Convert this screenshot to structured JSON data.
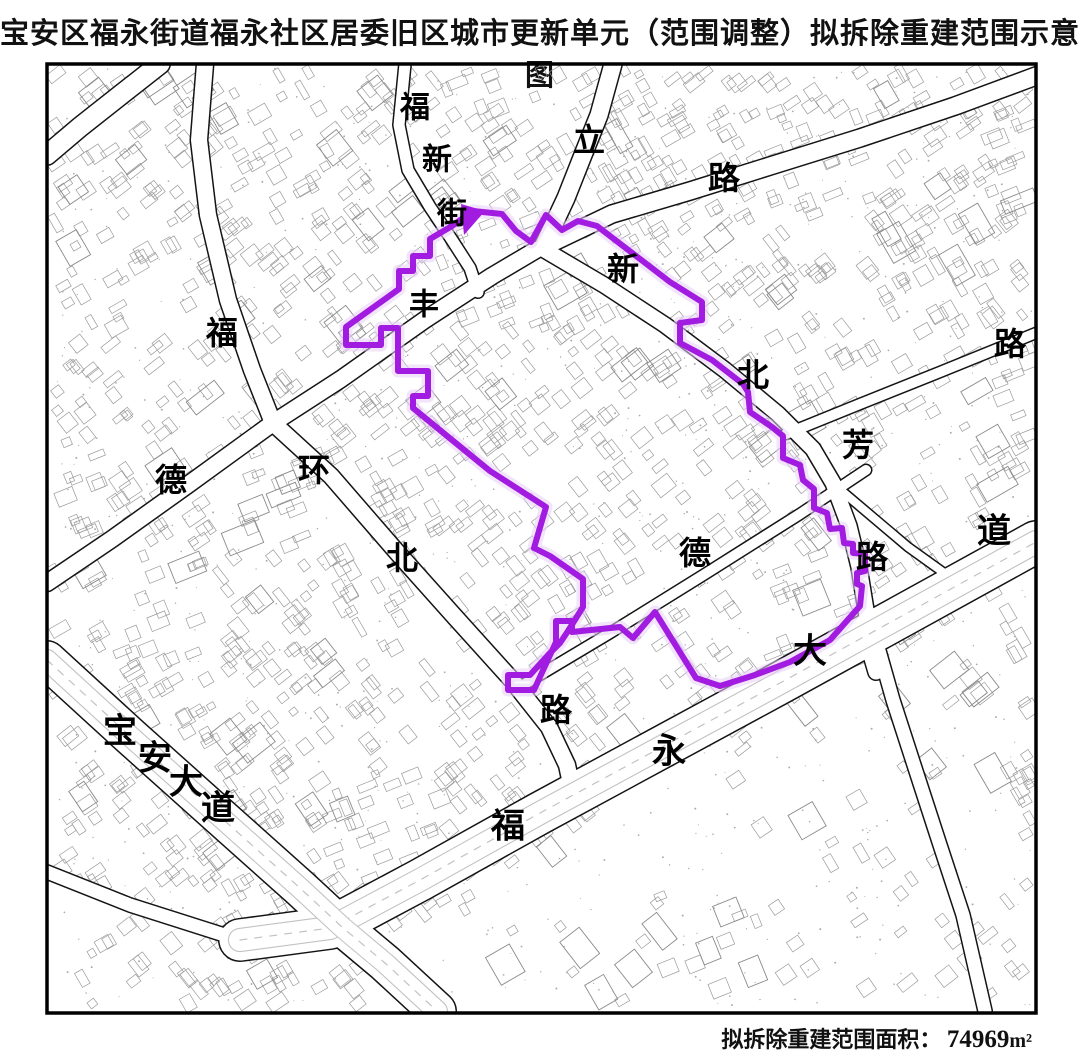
{
  "title": "宝安区福永街道福永社区居委旧区城市更新单元（范围调整）拟拆除重建范围示意图",
  "footer": {
    "label": "拟拆除重建范围面积：",
    "value": "74969",
    "unit": "m²"
  },
  "map": {
    "frame": {
      "x": 47,
      "y": 64,
      "w": 989,
      "h": 949
    },
    "colors": {
      "boundary": "#a21be0",
      "boundary_halo": "#e7cdf6",
      "road_casing": "#141414",
      "road_fill": "#ffffff",
      "avenue_inner": "#c2c2c2",
      "parcel": "#9b9b9b",
      "dot": "#ababab",
      "frame": "#000000",
      "label": "#000000"
    },
    "road_labels": [
      {
        "ch": "福",
        "x": 415,
        "y": 108,
        "s": 30
      },
      {
        "ch": "新",
        "x": 437,
        "y": 160,
        "s": 30
      },
      {
        "ch": "街",
        "x": 452,
        "y": 214,
        "s": 30
      },
      {
        "ch": "立",
        "x": 589,
        "y": 140,
        "s": 32
      },
      {
        "ch": "路",
        "x": 724,
        "y": 178,
        "s": 32
      },
      {
        "ch": "新",
        "x": 623,
        "y": 269,
        "s": 32
      },
      {
        "ch": "北",
        "x": 753,
        "y": 375,
        "s": 32
      },
      {
        "ch": "芳",
        "x": 858,
        "y": 445,
        "s": 32
      },
      {
        "ch": "路",
        "x": 1010,
        "y": 344,
        "s": 32
      },
      {
        "ch": "丰",
        "x": 424,
        "y": 305,
        "s": 30
      },
      {
        "ch": "福",
        "x": 222,
        "y": 333,
        "s": 32
      },
      {
        "ch": "德",
        "x": 171,
        "y": 480,
        "s": 32
      },
      {
        "ch": "环",
        "x": 314,
        "y": 470,
        "s": 32
      },
      {
        "ch": "北",
        "x": 402,
        "y": 558,
        "s": 32
      },
      {
        "ch": "路",
        "x": 556,
        "y": 710,
        "s": 32
      },
      {
        "ch": "德",
        "x": 695,
        "y": 553,
        "s": 32
      },
      {
        "ch": "路",
        "x": 872,
        "y": 557,
        "s": 32
      },
      {
        "ch": "福",
        "x": 508,
        "y": 827,
        "s": 34
      },
      {
        "ch": "永",
        "x": 669,
        "y": 752,
        "s": 34
      },
      {
        "ch": "大",
        "x": 810,
        "y": 652,
        "s": 34
      },
      {
        "ch": "道",
        "x": 994,
        "y": 532,
        "s": 34
      },
      {
        "ch": "宝",
        "x": 120,
        "y": 732,
        "s": 34
      },
      {
        "ch": "安",
        "x": 155,
        "y": 759,
        "s": 34
      },
      {
        "ch": "大",
        "x": 186,
        "y": 783,
        "s": 34
      },
      {
        "ch": "道",
        "x": 218,
        "y": 809,
        "s": 34
      }
    ],
    "roads": [
      {
        "name": "fuxin-street",
        "w": 14,
        "pts": [
          [
            405,
            64
          ],
          [
            399,
            125
          ],
          [
            408,
            170
          ],
          [
            430,
            207
          ],
          [
            452,
            240
          ],
          [
            470,
            268
          ],
          [
            478,
            292
          ]
        ]
      },
      {
        "name": "north-leg",
        "w": 20,
        "pts": [
          [
            613,
            64
          ],
          [
            599,
            115
          ],
          [
            583,
            155
          ],
          [
            566,
            198
          ],
          [
            551,
            230
          ],
          [
            543,
            247
          ]
        ]
      },
      {
        "name": "ene-road",
        "w": 20,
        "pts": [
          [
            543,
            247
          ],
          [
            612,
            214
          ],
          [
            690,
            191
          ],
          [
            770,
            166
          ],
          [
            860,
            138
          ],
          [
            955,
            106
          ],
          [
            1036,
            76
          ]
        ]
      },
      {
        "name": "road-a",
        "w": 18,
        "pts": [
          [
            543,
            249
          ],
          [
            604,
            285
          ],
          [
            665,
            325
          ],
          [
            725,
            370
          ],
          [
            778,
            414
          ],
          [
            813,
            449
          ],
          [
            833,
            483
          ],
          [
            849,
            526
          ],
          [
            859,
            567
          ],
          [
            866,
            610
          ],
          [
            871,
            655
          ],
          [
            876,
            672
          ]
        ]
      },
      {
        "name": "nwse-road",
        "w": 19,
        "pts": [
          [
            205,
            64
          ],
          [
            199,
            140
          ],
          [
            208,
            215
          ],
          [
            228,
            300
          ],
          [
            252,
            370
          ],
          [
            273,
            423
          ],
          [
            331,
            476
          ],
          [
            396,
            551
          ],
          [
            455,
            617
          ],
          [
            511,
            679
          ],
          [
            549,
            727
          ],
          [
            567,
            765
          ],
          [
            573,
            793
          ]
        ]
      },
      {
        "name": "swne-road",
        "w": 19,
        "pts": [
          [
            47,
            583
          ],
          [
            112,
            539
          ],
          [
            189,
            484
          ],
          [
            273,
            423
          ],
          [
            341,
            379
          ],
          [
            426,
            319
          ],
          [
            492,
            276
          ],
          [
            536,
            250
          ]
        ]
      },
      {
        "name": "inner-road",
        "w": 13,
        "pts": [
          [
            518,
            688
          ],
          [
            610,
            633
          ],
          [
            705,
            574
          ],
          [
            800,
            514
          ],
          [
            866,
            470
          ]
        ]
      },
      {
        "name": "ne-diagonal",
        "w": 13,
        "pts": [
          [
            786,
            434
          ],
          [
            860,
            404
          ],
          [
            940,
            372
          ],
          [
            1036,
            333
          ]
        ]
      },
      {
        "name": "branch-road",
        "w": 11,
        "pts": [
          [
            843,
            492
          ],
          [
            908,
            547
          ],
          [
            972,
            593
          ]
        ]
      },
      {
        "name": "corner-road",
        "w": 22,
        "pts": [
          [
            160,
            64
          ],
          [
            118,
            97
          ],
          [
            80,
            127
          ],
          [
            47,
            155
          ]
        ]
      },
      {
        "name": "west-stub",
        "w": 16,
        "pts": [
          [
            47,
            872
          ],
          [
            130,
            905
          ],
          [
            240,
            940
          ]
        ]
      },
      {
        "name": "se-road",
        "w": 16,
        "pts": [
          [
            876,
            640
          ],
          [
            893,
            700
          ],
          [
            915,
            768
          ],
          [
            940,
            845
          ],
          [
            963,
            915
          ],
          [
            985,
            1011
          ]
        ]
      },
      {
        "name": "fuyong-avenue",
        "w": 44,
        "pts": [
          [
            240,
            940
          ],
          [
            330,
            928
          ],
          [
            420,
            880
          ],
          [
            540,
            813
          ],
          [
            660,
            748
          ],
          [
            780,
            683
          ],
          [
            900,
            617
          ],
          [
            1036,
            542
          ]
        ]
      },
      {
        "name": "baoan-avenue",
        "w": 40,
        "pts": [
          [
            47,
            660
          ],
          [
            130,
            736
          ],
          [
            216,
            813
          ],
          [
            300,
            888
          ],
          [
            342,
            927
          ],
          [
            385,
            963
          ],
          [
            437,
            1011
          ]
        ]
      }
    ],
    "boundary": {
      "points": [
        [
          473,
          211
        ],
        [
          502,
          214
        ],
        [
          516,
          231
        ],
        [
          531,
          242
        ],
        [
          546,
          215
        ],
        [
          562,
          230
        ],
        [
          578,
          221
        ],
        [
          597,
          226
        ],
        [
          670,
          282
        ],
        [
          702,
          302
        ],
        [
          702,
          320
        ],
        [
          680,
          323
        ],
        [
          680,
          343
        ],
        [
          712,
          360
        ],
        [
          743,
          384
        ],
        [
          748,
          392
        ],
        [
          750,
          412
        ],
        [
          772,
          427
        ],
        [
          783,
          436
        ],
        [
          783,
          458
        ],
        [
          800,
          465
        ],
        [
          803,
          480
        ],
        [
          814,
          489
        ],
        [
          814,
          508
        ],
        [
          827,
          513
        ],
        [
          830,
          529
        ],
        [
          842,
          528
        ],
        [
          844,
          543
        ],
        [
          853,
          544
        ],
        [
          853,
          553
        ],
        [
          865,
          554
        ],
        [
          865,
          571
        ],
        [
          857,
          573
        ],
        [
          857,
          584
        ],
        [
          862,
          586
        ],
        [
          860,
          606
        ],
        [
          830,
          640
        ],
        [
          790,
          662
        ],
        [
          755,
          675
        ],
        [
          720,
          686
        ],
        [
          696,
          678
        ],
        [
          655,
          612
        ],
        [
          633,
          638
        ],
        [
          620,
          627
        ],
        [
          572,
          632
        ],
        [
          572,
          621
        ],
        [
          556,
          621
        ],
        [
          556,
          642
        ],
        [
          534,
          690
        ],
        [
          508,
          690
        ],
        [
          508,
          675
        ],
        [
          530,
          675
        ],
        [
          549,
          654
        ],
        [
          560,
          643
        ],
        [
          568,
          631
        ],
        [
          583,
          607
        ],
        [
          583,
          579
        ],
        [
          550,
          556
        ],
        [
          534,
          548
        ],
        [
          546,
          507
        ],
        [
          490,
          471
        ],
        [
          452,
          440
        ],
        [
          413,
          408
        ],
        [
          413,
          396
        ],
        [
          428,
          396
        ],
        [
          428,
          371
        ],
        [
          398,
          371
        ],
        [
          398,
          328
        ],
        [
          381,
          328
        ],
        [
          381,
          345
        ],
        [
          346,
          345
        ],
        [
          346,
          327
        ],
        [
          399,
          289
        ],
        [
          399,
          271
        ],
        [
          413,
          271
        ],
        [
          413,
          256
        ],
        [
          430,
          256
        ],
        [
          430,
          239
        ],
        [
          452,
          226
        ]
      ],
      "arrow": [
        [
          461,
          204
        ],
        [
          485,
          211
        ],
        [
          464,
          235
        ]
      ]
    }
  }
}
